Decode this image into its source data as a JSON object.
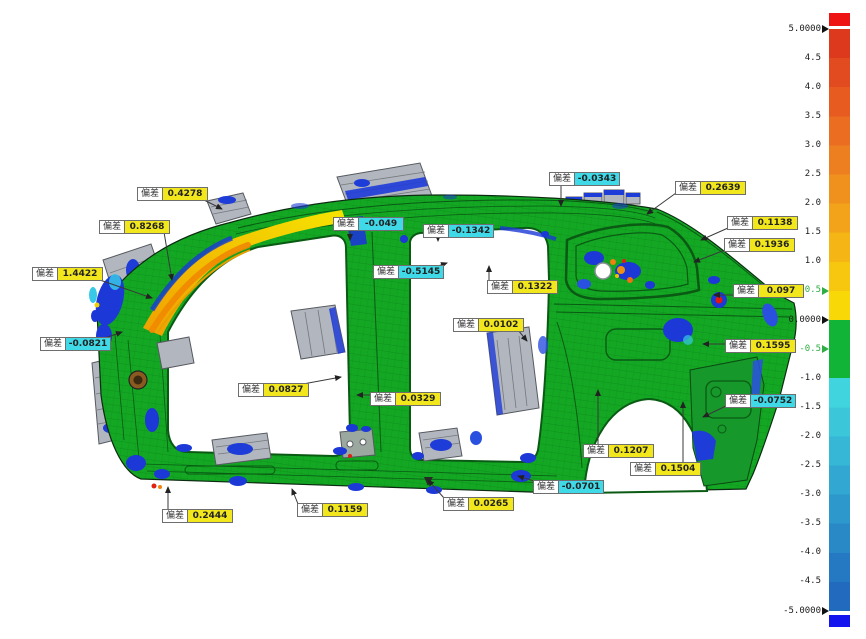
{
  "viewport": {
    "background": "#ffffff"
  },
  "callout_label": "偏差",
  "callout_style": {
    "positive_bg": "#f2e71c",
    "negative_bg": "#3fd9e8",
    "name_bg": "#ffffff",
    "border": "#6e6e6e"
  },
  "annotations": [
    {
      "value": "0.4278",
      "x": 137,
      "y": 187,
      "tx": 222,
      "ty": 209
    },
    {
      "value": "0.8268",
      "x": 99,
      "y": 220,
      "tx": 172,
      "ty": 280
    },
    {
      "value": "1.4422",
      "x": 32,
      "y": 267,
      "tx": 152,
      "ty": 298
    },
    {
      "value": "-0.0821",
      "x": 40,
      "y": 337,
      "tx": 122,
      "ty": 332
    },
    {
      "value": "-0.049",
      "x": 333,
      "y": 217,
      "tx": 350,
      "ty": 240
    },
    {
      "value": "-0.1342",
      "x": 423,
      "y": 224,
      "tx": 438,
      "ty": 241
    },
    {
      "value": "-0.5145",
      "x": 373,
      "y": 265,
      "tx": 447,
      "ty": 263
    },
    {
      "value": "-0.0343",
      "x": 549,
      "y": 172,
      "tx": 561,
      "ty": 206
    },
    {
      "value": "0.2639",
      "x": 675,
      "y": 181,
      "tx": 647,
      "ty": 214
    },
    {
      "value": "0.1138",
      "x": 727,
      "y": 216,
      "tx": 701,
      "ty": 240
    },
    {
      "value": "0.1936",
      "x": 724,
      "y": 238,
      "tx": 694,
      "ty": 262
    },
    {
      "value": "0.097",
      "x": 733,
      "y": 284,
      "tx": 714,
      "ty": 295
    },
    {
      "value": "0.1322",
      "x": 487,
      "y": 280,
      "tx": 489,
      "ty": 266
    },
    {
      "value": "0.0102",
      "x": 453,
      "y": 318,
      "tx": 527,
      "ty": 341
    },
    {
      "value": "0.1595",
      "x": 725,
      "y": 339,
      "tx": 703,
      "ty": 344
    },
    {
      "value": "-0.0752",
      "x": 725,
      "y": 394,
      "tx": 703,
      "ty": 417
    },
    {
      "value": "0.0827",
      "x": 238,
      "y": 383,
      "tx": 341,
      "ty": 377
    },
    {
      "value": "0.0329",
      "x": 370,
      "y": 392,
      "tx": 357,
      "ty": 395
    },
    {
      "value": "0.1207",
      "x": 583,
      "y": 444,
      "tx": 598,
      "ty": 390
    },
    {
      "value": "0.1504",
      "x": 630,
      "y": 462,
      "tx": 683,
      "ty": 402
    },
    {
      "value": "-0.0701",
      "x": 533,
      "y": 480,
      "tx": 518,
      "ty": 476
    },
    {
      "value": "0.2444",
      "x": 162,
      "y": 509,
      "tx": 168,
      "ty": 487
    },
    {
      "value": "0.1159",
      "x": 297,
      "y": 503,
      "tx": 292,
      "ty": 489
    },
    {
      "value": "0.0265",
      "x": 443,
      "y": 497,
      "tx": 428,
      "ty": 480
    }
  ],
  "color_scale": {
    "range": [
      -5,
      5
    ],
    "overflow_high_color": "#ee1414",
    "overflow_low_color": "#1414ee",
    "band_colors": [
      "#dd3a1d",
      "#e24a1f",
      "#e75b21",
      "#eb6d22",
      "#ee7f21",
      "#f0911e",
      "#f2a31a",
      "#f4b515",
      "#f6c70e",
      "#f8d907",
      "#12b437",
      "#12b437",
      "#40d5de",
      "#3bc6da",
      "#36b7d6",
      "#31a7d1",
      "#2d98cc",
      "#2989c7",
      "#2579c2",
      "#216abd"
    ],
    "ticks": [
      {
        "label": "5.0000",
        "value": 5,
        "green": false,
        "arrow": true
      },
      {
        "label": "4.5",
        "value": 4.5,
        "green": false,
        "arrow": false
      },
      {
        "label": "4.0",
        "value": 4,
        "green": false,
        "arrow": false
      },
      {
        "label": "3.5",
        "value": 3.5,
        "green": false,
        "arrow": false
      },
      {
        "label": "3.0",
        "value": 3,
        "green": false,
        "arrow": false
      },
      {
        "label": "2.5",
        "value": 2.5,
        "green": false,
        "arrow": false
      },
      {
        "label": "2.0",
        "value": 2,
        "green": false,
        "arrow": false
      },
      {
        "label": "1.5",
        "value": 1.5,
        "green": false,
        "arrow": false
      },
      {
        "label": "1.0",
        "value": 1,
        "green": false,
        "arrow": false
      },
      {
        "label": "0.5",
        "value": 0.5,
        "green": true,
        "arrow": true
      },
      {
        "label": "0.0000",
        "value": 0,
        "green": false,
        "arrow": true
      },
      {
        "label": "-0.5",
        "value": -0.5,
        "green": true,
        "arrow": true
      },
      {
        "label": "-1.0",
        "value": -1,
        "green": false,
        "arrow": false
      },
      {
        "label": "-1.5",
        "value": -1.5,
        "green": false,
        "arrow": false
      },
      {
        "label": "-2.0",
        "value": -2,
        "green": false,
        "arrow": false
      },
      {
        "label": "-2.5",
        "value": -2.5,
        "green": false,
        "arrow": false
      },
      {
        "label": "-3.0",
        "value": -3,
        "green": false,
        "arrow": false
      },
      {
        "label": "-3.5",
        "value": -3.5,
        "green": false,
        "arrow": false
      },
      {
        "label": "-4.0",
        "value": -4,
        "green": false,
        "arrow": false
      },
      {
        "label": "-4.5",
        "value": -4.5,
        "green": false,
        "arrow": false
      },
      {
        "label": "-5.0000",
        "value": -5,
        "green": false,
        "arrow": true
      }
    ]
  },
  "model_colors": {
    "nominal_green": "#13a723",
    "positive_hot": "#f0a800",
    "negative_cold": "#1c38d6",
    "reference_gray": "#b2b6be"
  }
}
